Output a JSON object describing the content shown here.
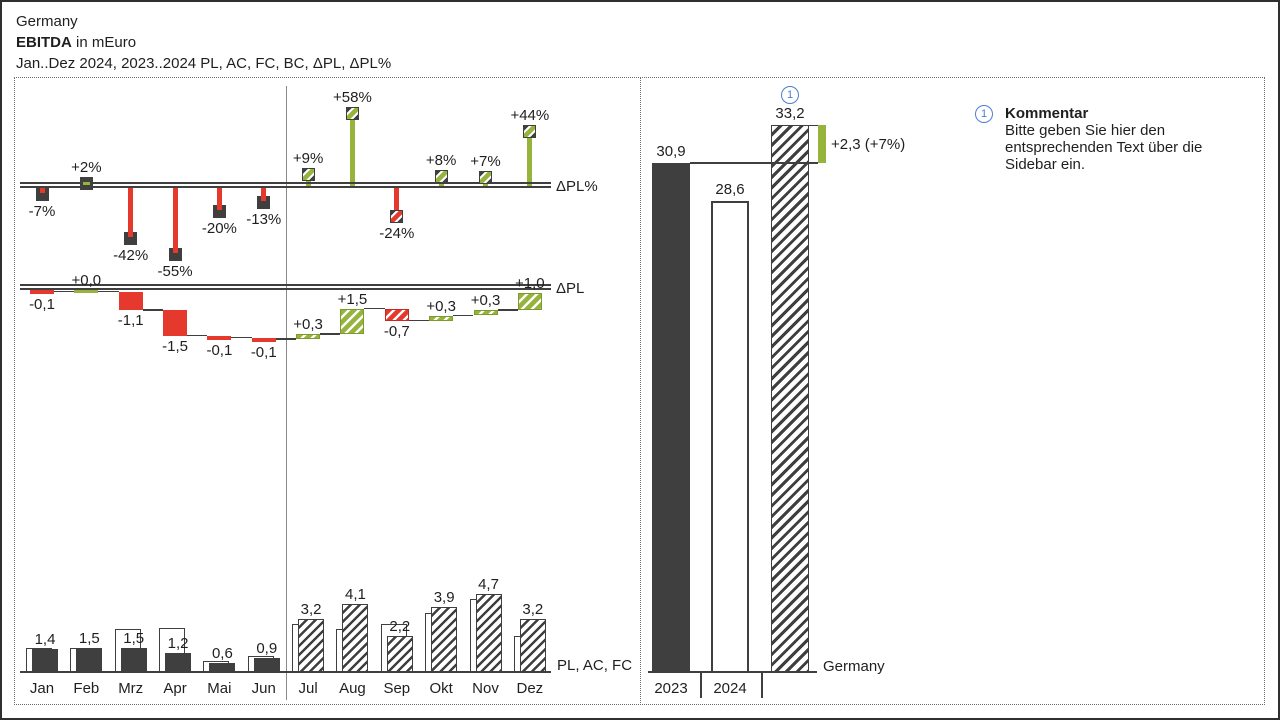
{
  "header": {
    "title": "Germany",
    "kpi": "EBITDA",
    "kpi_suffix": " in mEuro",
    "subtitle": "Jan..Dez 2024, 2023..2024 PL, AC, FC, BC, ΔPL, ΔPL%"
  },
  "axes": {
    "pct_label": "ΔPL%",
    "abs_label": "ΔPL",
    "series_label": "PL, AC, FC",
    "year_series_label": "Germany"
  },
  "chart_data": {
    "type": "bar",
    "title": "Germany EBITDA in mEuro",
    "subtitle": "Jan..Dez 2024, 2023..2024 PL, AC, FC, BC, ΔPL, ΔPL%",
    "panels": [
      "ΔPL% pin chart",
      "ΔPL waterfall",
      "monthly PL/AC/FC bars",
      "yearly totals"
    ],
    "categories": [
      "Jan",
      "Feb",
      "Mrz",
      "Apr",
      "Mai",
      "Jun",
      "Jul",
      "Aug",
      "Sep",
      "Okt",
      "Nov",
      "Dez"
    ],
    "units": "mEuro",
    "months": [
      {
        "label": "Jan",
        "scenario": "AC",
        "value": 1.4,
        "value_label": "1,4",
        "pl": 1.5,
        "dpl": -0.1,
        "dpl_label": "-0,1",
        "pct": -7,
        "pct_label": "-7%"
      },
      {
        "label": "Feb",
        "scenario": "AC",
        "value": 1.5,
        "value_label": "1,5",
        "pl": 1.5,
        "dpl": 0.0,
        "dpl_label": "+0,0",
        "pct": 2,
        "pct_label": "+2%"
      },
      {
        "label": "Mrz",
        "scenario": "AC",
        "value": 1.5,
        "value_label": "1,5",
        "pl": 2.6,
        "dpl": -1.1,
        "dpl_label": "-1,1",
        "pct": -42,
        "pct_label": "-42%"
      },
      {
        "label": "Apr",
        "scenario": "AC",
        "value": 1.2,
        "value_label": "1,2",
        "pl": 2.7,
        "dpl": -1.5,
        "dpl_label": "-1,5",
        "pct": -55,
        "pct_label": "-55%"
      },
      {
        "label": "Mai",
        "scenario": "AC",
        "value": 0.6,
        "value_label": "0,6",
        "pl": 0.7,
        "dpl": -0.1,
        "dpl_label": "-0,1",
        "pct": -20,
        "pct_label": "-20%"
      },
      {
        "label": "Jun",
        "scenario": "AC",
        "value": 0.9,
        "value_label": "0,9",
        "pl": 1.0,
        "dpl": -0.1,
        "dpl_label": "-0,1",
        "pct": -13,
        "pct_label": "-13%"
      },
      {
        "label": "Jul",
        "scenario": "FC",
        "value": 3.2,
        "value_label": "3,2",
        "pl": 2.9,
        "dpl": 0.3,
        "dpl_label": "+0,3",
        "pct": 9,
        "pct_label": "+9%"
      },
      {
        "label": "Aug",
        "scenario": "FC",
        "value": 4.1,
        "value_label": "4,1",
        "pl": 2.6,
        "dpl": 1.5,
        "dpl_label": "+1,5",
        "pct": 58,
        "pct_label": "+58%"
      },
      {
        "label": "Sep",
        "scenario": "FC",
        "value": 2.2,
        "value_label": "2,2",
        "pl": 2.9,
        "dpl": -0.7,
        "dpl_label": "-0,7",
        "pct": -24,
        "pct_label": "-24%"
      },
      {
        "label": "Okt",
        "scenario": "FC",
        "value": 3.9,
        "value_label": "3,9",
        "pl": 3.6,
        "dpl": 0.3,
        "dpl_label": "+0,3",
        "pct": 8,
        "pct_label": "+8%"
      },
      {
        "label": "Nov",
        "scenario": "FC",
        "value": 4.7,
        "value_label": "4,7",
        "pl": 4.4,
        "dpl": 0.3,
        "dpl_label": "+0,3",
        "pct": 7,
        "pct_label": "+7%"
      },
      {
        "label": "Dez",
        "scenario": "FC",
        "value": 3.2,
        "value_label": "3,2",
        "pl": 2.2,
        "dpl": 1.0,
        "dpl_label": "+1,0",
        "pct": 44,
        "pct_label": "+44%"
      }
    ],
    "years": [
      {
        "label": "2023",
        "value": 30.9,
        "value_label": "30,9",
        "style": "ac"
      },
      {
        "label": "2024",
        "value": 28.6,
        "value_label": "28,6",
        "style": "pl"
      },
      {
        "label": "",
        "value": 33.2,
        "value_label": "33,2",
        "style": "fc",
        "note": "1"
      }
    ],
    "variance": {
      "value": 2.3,
      "pct": 7,
      "label": "+2,3 (+7%)"
    }
  },
  "comment": {
    "ref": "1",
    "title": "Kommentar",
    "lines": [
      "Bitte geben Sie hier den",
      "entsprechenden Text über die",
      "Sidebar ein."
    ]
  },
  "colors": {
    "positive": "#96b43c",
    "negative": "#e5392e",
    "actual": "#3f3f3f",
    "annotation_blue": "#4a7fd0"
  }
}
